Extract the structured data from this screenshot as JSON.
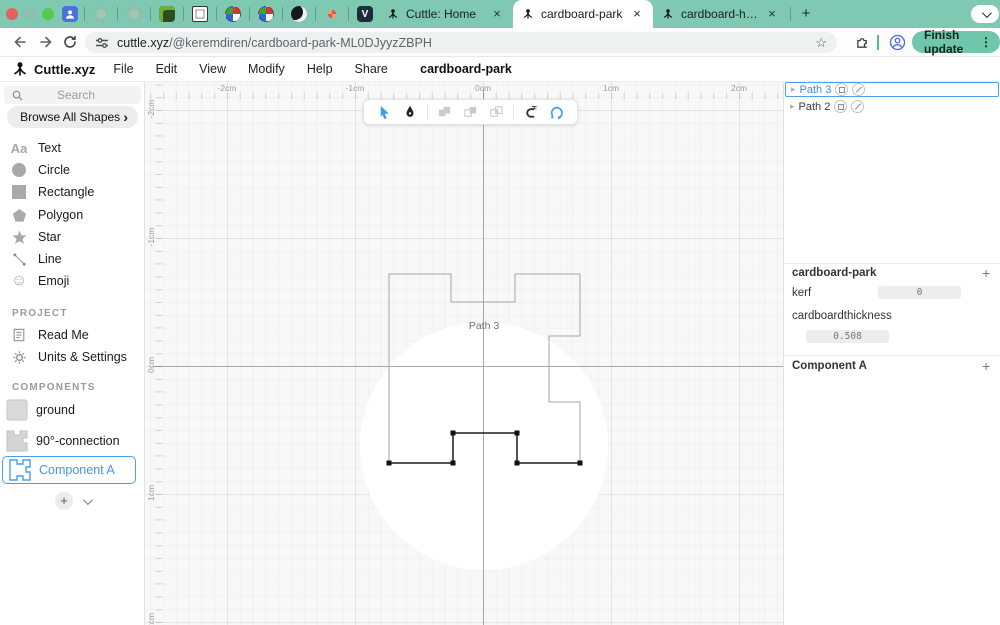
{
  "browser": {
    "pinned_tab_icons": [
      "profile-tile-icon",
      "leaf-icon",
      "leaf-icon",
      "frog-icon",
      "book-icon",
      "pinwheel-icon",
      "pinwheel-icon",
      "moon-icon",
      "sparkle-icon",
      "v-tile-icon"
    ],
    "tabs": [
      {
        "title": "Cuttle: Home"
      },
      {
        "title": "cardboard-park"
      },
      {
        "title": "cardboard-house"
      }
    ],
    "url_domain": "cuttle.xyz",
    "url_path": "/@keremdiren/cardboard-park-ML0DJyyzZBPH",
    "finish_button_label": "Finish update",
    "v_tile_letter": "V"
  },
  "menu": {
    "brand": "Cuttle.xyz",
    "items": [
      {
        "label": "File"
      },
      {
        "label": "Edit"
      },
      {
        "label": "View"
      },
      {
        "label": "Modify"
      },
      {
        "label": "Help"
      },
      {
        "label": "Share"
      }
    ],
    "document_title": "cardboard-park"
  },
  "sidebar": {
    "search_placeholder": "Search",
    "browse_all_label": "Browse All Shapes",
    "shapes": [
      {
        "label": "Text",
        "icon_text": "Aa"
      },
      {
        "label": "Circle"
      },
      {
        "label": "Rectangle"
      },
      {
        "label": "Polygon"
      },
      {
        "label": "Star"
      },
      {
        "label": "Line"
      },
      {
        "label": "Emoji"
      }
    ],
    "project_header": "PROJECT",
    "project_items": [
      {
        "label": "Read Me"
      },
      {
        "label": "Units & Settings"
      }
    ],
    "components_header": "COMPONENTS",
    "components": [
      {
        "label": "ground"
      },
      {
        "label": "90°-connection"
      },
      {
        "label": "Component A",
        "selected": true
      }
    ]
  },
  "canvas": {
    "ruler_x": [
      "-2cm",
      "-1cm",
      "0cm",
      "1cm",
      "2cm"
    ],
    "ruler_y": [
      "-2cm",
      "-1cm",
      "0cm",
      "1cm",
      "2cm"
    ],
    "shape_label": "Path 3"
  },
  "inspector": {
    "outline": [
      {
        "name": "Path 3",
        "selected": true
      },
      {
        "name": "Path 2"
      }
    ],
    "project_section": {
      "title": "cardboard-park",
      "params": [
        {
          "name": "kerf",
          "value": "0"
        },
        {
          "name": "cardboardthickness",
          "value": "0.508"
        }
      ]
    },
    "component_section": {
      "title": "Component A"
    }
  },
  "glyphs": {
    "close": "×",
    "plus": "+",
    "star": "☆",
    "dots_vertical": "⋮",
    "chevron_right": "›",
    "triangle_right": "▸",
    "smiley": "☺"
  },
  "colors": {
    "tab_teal": "#7fc9b2",
    "button_teal": "#6fc7ab",
    "accent_blue": "#3e9cf0",
    "selection_black": "#1b1b1b",
    "outline_gray": "#a5a5a5"
  }
}
